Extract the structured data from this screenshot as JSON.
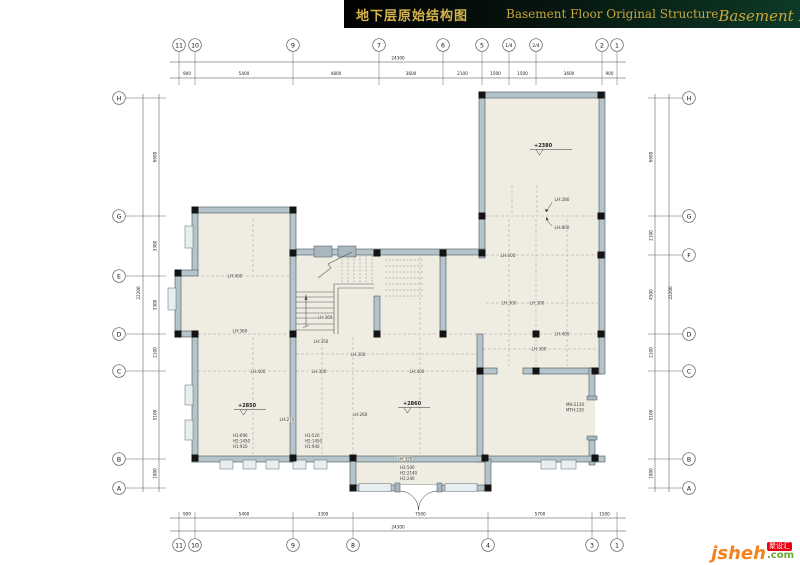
{
  "header": {
    "title_cn": "地下层原始结构图",
    "title_en": "Basement Floor Original Structure",
    "script_title": "Basement Floor",
    "script_b": "B",
    "script_f": "F"
  },
  "logo": {
    "brand": "jsheh",
    "tld": ".com",
    "badge": "聚设汇"
  },
  "grid": {
    "top": [
      "11",
      "10",
      "9",
      "7",
      "6",
      "5",
      "1/4",
      "2/4",
      "2",
      "1"
    ],
    "bottom": [
      "11",
      "10",
      "9",
      "8",
      "4",
      "3",
      "1"
    ],
    "left": [
      "H",
      "G",
      "E",
      "D",
      "C",
      "B",
      "A"
    ],
    "right": [
      "H",
      "G",
      "F",
      "D",
      "C",
      "B",
      "A"
    ]
  },
  "dims": {
    "top_total": "24300",
    "top_segments": [
      "900",
      "5400",
      "4800",
      "3600",
      "2100",
      "1500",
      "1500",
      "3600",
      "900"
    ],
    "bottom_total": "24300",
    "bottom_segments": [
      "900",
      "5400",
      "3300",
      "7500",
      "5700",
      "1500"
    ],
    "left_total": "22200",
    "left_segments": [
      "6600",
      "3300",
      "3300",
      "2100",
      "5100",
      "1800"
    ],
    "right_total": "22200",
    "right_segments": [
      "6600",
      "2100",
      "4500",
      "2100",
      "5100",
      "1800"
    ]
  },
  "plan": {
    "levels": [
      "+2380",
      "+2850",
      "+2860"
    ],
    "beam_labels": [
      "LH:400",
      "LH:360",
      "LH:360",
      "LH:350",
      "LH:300",
      "LH:400",
      "LH:300",
      "LH:400",
      "LH:270",
      "LH:260",
      "LH:600",
      "LH:300",
      "LH:300",
      "LH:400",
      "LH:300",
      "LH:320",
      "LH:280",
      "LH:800"
    ],
    "window_specs": [
      [
        "H3:690",
        "H2:1450",
        "H1:920"
      ],
      [
        "H3:520",
        "H2:1450",
        "H1:940"
      ],
      [
        "H3:500",
        "H2:2140",
        "H1:240"
      ]
    ],
    "door_spec": [
      "MH:2130",
      "MTH:230"
    ]
  }
}
